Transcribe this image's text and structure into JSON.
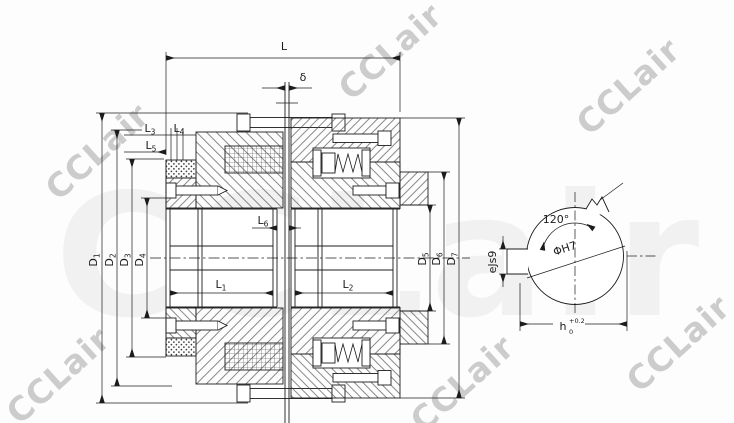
{
  "watermark": {
    "text": "CCLair"
  },
  "main_view": {
    "dims": {
      "L": "L",
      "delta": "δ",
      "L1": {
        "base": "L",
        "sub": "1"
      },
      "L2": {
        "base": "L",
        "sub": "2"
      },
      "L3": {
        "base": "L",
        "sub": "3"
      },
      "L4": {
        "base": "L",
        "sub": "4"
      },
      "L5": {
        "base": "L",
        "sub": "5"
      },
      "L6": {
        "base": "L",
        "sub": "6"
      },
      "D1": {
        "base": "D",
        "sub": "1"
      },
      "D2": {
        "base": "D",
        "sub": "2"
      },
      "D3": {
        "base": "D",
        "sub": "3"
      },
      "D4": {
        "base": "D",
        "sub": "4"
      },
      "D5": {
        "base": "D",
        "sub": "5"
      },
      "D6": {
        "base": "D",
        "sub": "6"
      },
      "D7": {
        "base": "D",
        "sub": "7"
      }
    }
  },
  "side_view": {
    "angle": "120°",
    "bore": "ΦH7",
    "key_width": "eJs9",
    "key_height": {
      "base": "h",
      "sup": "+0.2",
      "sub": "0"
    }
  }
}
